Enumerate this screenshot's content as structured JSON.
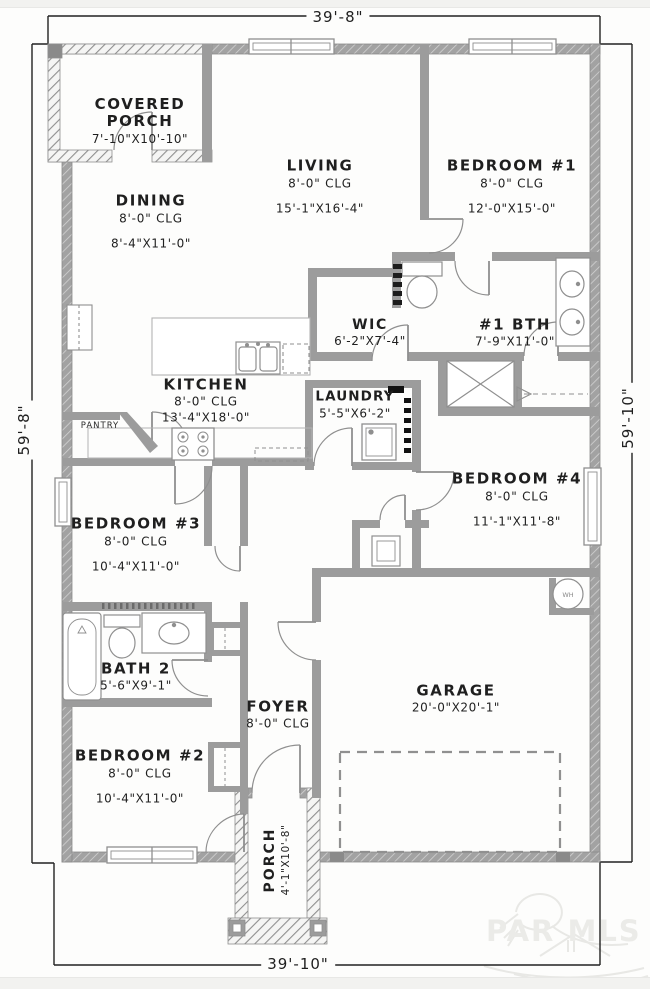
{
  "drawing": {
    "dimensions": {
      "top": "39'-8\"",
      "bottom": "39'-10\"",
      "left": "59'-8\"",
      "right": "59'-10\""
    },
    "rooms": {
      "covered_porch": {
        "name": "COVERED PORCH",
        "size": "7'-10\"X10'-10\""
      },
      "living": {
        "name": "LIVING",
        "ceiling": "8'-0\" CLG",
        "size": "15'-1\"X16'-4\""
      },
      "bedroom1": {
        "name": "BEDROOM #1",
        "ceiling": "8'-0\" CLG",
        "size": "12'-0\"X15'-0\""
      },
      "dining": {
        "name": "DINING",
        "ceiling": "8'-0\" CLG",
        "size": "8'-4\"X11'-0\""
      },
      "wic": {
        "name": "WIC",
        "size": "6'-2\"X7'-4\""
      },
      "bath1": {
        "name": "#1 BTH",
        "size": "7'-9\"X11'-0\""
      },
      "kitchen": {
        "name": "KITCHEN",
        "ceiling": "8'-0\" CLG",
        "size": "13'-4\"X18'-0\""
      },
      "pantry": {
        "name": "PANTRY"
      },
      "laundry": {
        "name": "LAUNDRY",
        "size": "5'-5\"X6'-2\""
      },
      "bedroom4": {
        "name": "BEDROOM #4",
        "ceiling": "8'-0\" CLG",
        "size": "11'-1\"X11'-8\""
      },
      "bedroom3": {
        "name": "BEDROOM #3",
        "ceiling": "8'-0\" CLG",
        "size": "10'-4\"X11'-0\""
      },
      "bath2": {
        "name": "BATH 2",
        "size": "5'-6\"X9'-1\""
      },
      "bedroom2": {
        "name": "BEDROOM #2",
        "ceiling": "8'-0\" CLG",
        "size": "10'-4\"X11'-0\""
      },
      "foyer": {
        "name": "FOYER",
        "ceiling": "8'-0\" CLG"
      },
      "garage": {
        "name": "GARAGE",
        "size": "20'-0\"X20'-1\""
      },
      "porch": {
        "name": "PORCH",
        "size": "4'-1\"X10'-8\""
      }
    },
    "fixtures": {
      "water_heater": "WH"
    },
    "watermark": {
      "text": "PAR MLS"
    },
    "colors": {
      "wall": "#9c9c9c",
      "line": "#8f8f8f",
      "dimension_line": "#222222",
      "text": "#1f1f1f",
      "background": "#fdfdfc",
      "frame": "#f2f2f0",
      "watermark": "#e8e8e5"
    }
  }
}
